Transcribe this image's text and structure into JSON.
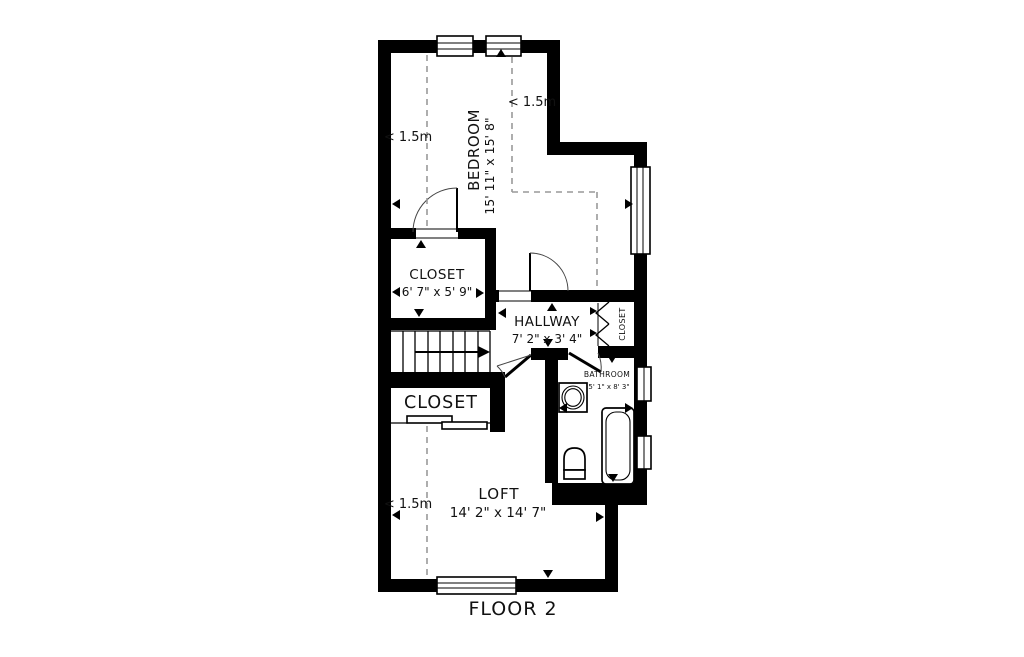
{
  "page": {
    "background": "#ffffff"
  },
  "floor_plan": {
    "title": "FLOOR 2",
    "wall_color": "#000000",
    "dashed_line_color": "#999999",
    "rooms": {
      "bedroom": {
        "name": "BEDROOM",
        "dims": "15' 11\" x 15' 8\""
      },
      "upper_closet": {
        "name": "CLOSET",
        "dims": "6' 7\" x 5' 9\""
      },
      "hallway": {
        "name": "HALLWAY",
        "dims": "7' 2\" x 3' 4\""
      },
      "hall_closet": {
        "name": "CLOSET"
      },
      "bathroom": {
        "name": "BATHROOM",
        "dims": "5' 1\" x 8' 3\""
      },
      "lower_closet": {
        "name": "CLOSET"
      },
      "loft": {
        "name": "LOFT",
        "dims": "14' 2\" x 14' 7\""
      }
    },
    "low_ceiling_labels": {
      "bedroom_left": "< 1.5m",
      "bedroom_top": "< 1.5m",
      "loft_left": "< 1.5m"
    }
  }
}
